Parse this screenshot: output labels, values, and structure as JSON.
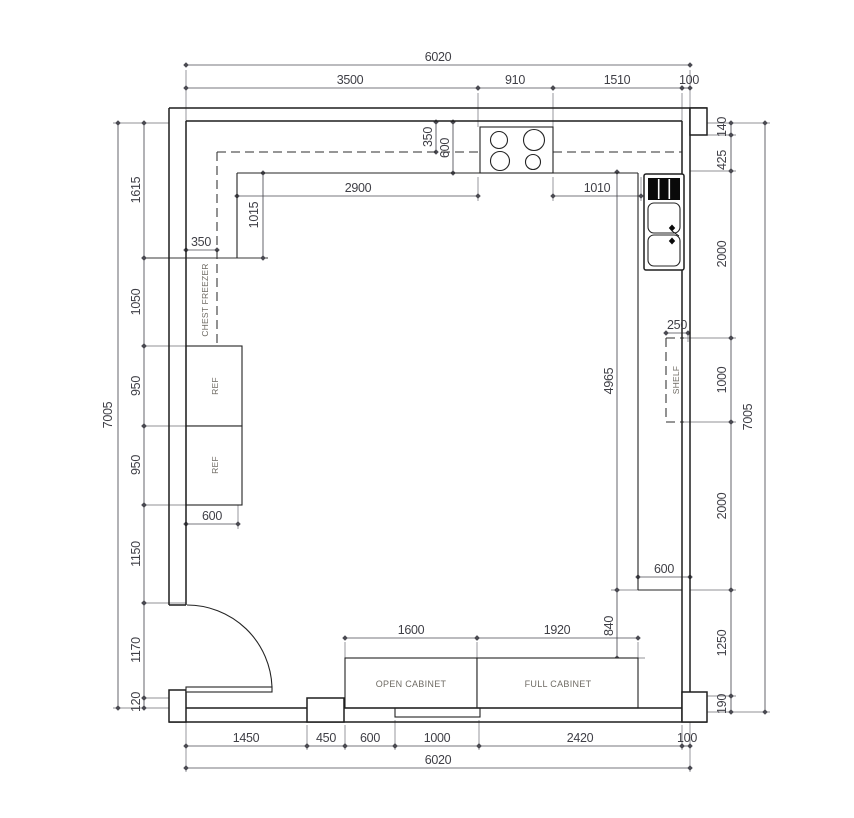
{
  "dims": {
    "top": {
      "total": "6020",
      "segments": [
        "3500",
        "910",
        "1510",
        "100"
      ]
    },
    "bottom": {
      "total": "6020",
      "segments": [
        "1450",
        "450",
        "600",
        "1000",
        "2420",
        "100"
      ],
      "open_cabinet_width": "1600",
      "full_cabinet_width": "1920"
    },
    "left": {
      "total": "7005",
      "segments": [
        "1615",
        "1050",
        "950",
        "950",
        "1150",
        "1170",
        "120"
      ]
    },
    "right": {
      "total": "7005",
      "segments": [
        "140",
        "425",
        "2000",
        "1000",
        "2000",
        "1250",
        "190"
      ],
      "counter_run": "4965",
      "counter_gap": "840",
      "shelf_depth": "250",
      "counter_depth": "600"
    },
    "interior": {
      "counter_length": "2900",
      "hob_to_sink": "1010",
      "wall_band_depth": "350",
      "counter_depth": "600",
      "corner_return": "1015",
      "freezer_depth": "350",
      "ref_depth": "600"
    }
  },
  "fixtures": {
    "chest_freezer": "CHEST FREEZER",
    "ref_top": "REF",
    "ref_bottom": "REF",
    "shelf": "SHELF",
    "open_cabinet": "OPEN CABINET",
    "full_cabinet": "FULL CABINET"
  },
  "colors": {
    "line": "#1f1f1f",
    "dimension": "#4a4a52",
    "fixture_label": "#6f6b64",
    "background": "#ffffff"
  }
}
